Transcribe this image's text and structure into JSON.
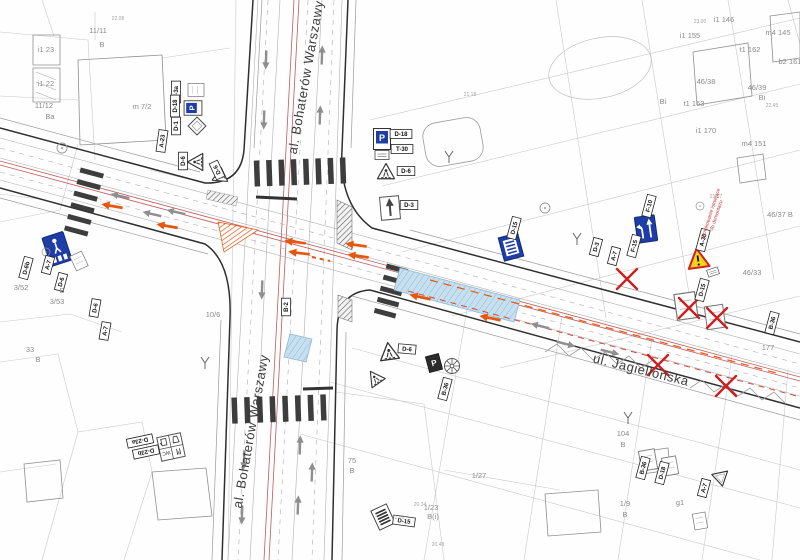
{
  "streets": [
    {
      "name": "al. Bohaterów Warszawy",
      "x": 310,
      "y": 78,
      "rot": -80
    },
    {
      "name": "al. Bohaterów Warszawy",
      "x": 255,
      "y": 432,
      "rot": -80
    },
    {
      "name": "ul. Jagiellońska",
      "x": 640,
      "y": 374,
      "rot": 14
    }
  ],
  "parcel_labels": [
    {
      "text": "11/11",
      "x": 98,
      "y": 33
    },
    {
      "text": "B",
      "x": 102,
      "y": 47
    },
    {
      "text": "i1 23",
      "x": 46,
      "y": 52
    },
    {
      "text": "i1 22",
      "x": 46,
      "y": 86
    },
    {
      "text": "11/12",
      "x": 44,
      "y": 108
    },
    {
      "text": "Ba",
      "x": 50,
      "y": 119
    },
    {
      "text": "m 7/2",
      "x": 142,
      "y": 109
    },
    {
      "text": "i1 146",
      "x": 724,
      "y": 22
    },
    {
      "text": "i1 155",
      "x": 690,
      "y": 38
    },
    {
      "text": "m4 145",
      "x": 778,
      "y": 35
    },
    {
      "text": "t1 162",
      "x": 750,
      "y": 52
    },
    {
      "text": "b2 161",
      "x": 790,
      "y": 64
    },
    {
      "text": "46/38",
      "x": 706,
      "y": 84
    },
    {
      "text": "46/39",
      "x": 757,
      "y": 90
    },
    {
      "text": "Bi",
      "x": 762,
      "y": 100
    },
    {
      "text": "Bi",
      "x": 663,
      "y": 104
    },
    {
      "text": "t1 163",
      "x": 694,
      "y": 106
    },
    {
      "text": "i1 170",
      "x": 706,
      "y": 133
    },
    {
      "text": "m4 151",
      "x": 754,
      "y": 146
    },
    {
      "text": "46/37 B",
      "x": 780,
      "y": 217
    },
    {
      "text": "46/33",
      "x": 752,
      "y": 275
    },
    {
      "text": "177",
      "x": 768,
      "y": 350
    },
    {
      "text": "104",
      "x": 623,
      "y": 436
    },
    {
      "text": "B",
      "x": 623,
      "y": 447
    },
    {
      "text": "1/9",
      "x": 625,
      "y": 506
    },
    {
      "text": "B",
      "x": 625,
      "y": 517
    },
    {
      "text": "1/23",
      "x": 431,
      "y": 510
    },
    {
      "text": "B(i)",
      "x": 433,
      "y": 519
    },
    {
      "text": "75",
      "x": 352,
      "y": 463
    },
    {
      "text": "B",
      "x": 352,
      "y": 473
    },
    {
      "text": "1/27",
      "x": 479,
      "y": 478
    },
    {
      "text": "g1",
      "x": 680,
      "y": 505
    },
    {
      "text": "10/6",
      "x": 213,
      "y": 317
    },
    {
      "text": "3/52",
      "x": 21,
      "y": 290
    },
    {
      "text": "B",
      "x": 62,
      "y": 293
    },
    {
      "text": "3/53",
      "x": 57,
      "y": 304
    },
    {
      "text": "33",
      "x": 30,
      "y": 352
    },
    {
      "text": "B",
      "x": 38,
      "y": 362
    }
  ],
  "elevation_labels": [
    {
      "text": "23.00",
      "x": 700,
      "y": 23
    },
    {
      "text": "22.45",
      "x": 772,
      "y": 107
    },
    {
      "text": "21.57",
      "x": 716,
      "y": 198
    },
    {
      "text": "21.18",
      "x": 470,
      "y": 96
    },
    {
      "text": "21.01",
      "x": 398,
      "y": 519
    },
    {
      "text": "20.34",
      "x": 420,
      "y": 506
    },
    {
      "text": "20.48",
      "x": 438,
      "y": 546
    },
    {
      "text": "22.08",
      "x": 118,
      "y": 20
    }
  ],
  "sign_labels": [
    {
      "text": "D-18",
      "x": 401,
      "y": 134,
      "rot": 0
    },
    {
      "text": "T-30",
      "x": 402,
      "y": 149,
      "rot": 0
    },
    {
      "text": "D-6",
      "x": 406,
      "y": 171,
      "rot": 0
    },
    {
      "text": "D-3",
      "x": 409,
      "y": 205,
      "rot": 0
    },
    {
      "text": "T-3a",
      "x": 176,
      "y": 92,
      "rot": -90
    },
    {
      "text": "D-18",
      "x": 175,
      "y": 106,
      "rot": -90
    },
    {
      "text": "D-1",
      "x": 176,
      "y": 126,
      "rot": -90
    },
    {
      "text": "A-23",
      "x": 162,
      "y": 141,
      "rot": -82
    },
    {
      "text": "D-6",
      "x": 183,
      "y": 161,
      "rot": -90
    },
    {
      "text": "D-6",
      "x": 217,
      "y": 170,
      "rot": -115
    },
    {
      "text": "D-6b",
      "x": 26,
      "y": 268,
      "rot": -75
    },
    {
      "text": "A-7",
      "x": 48,
      "y": 265,
      "rot": -75
    },
    {
      "text": "D-6",
      "x": 61,
      "y": 282,
      "rot": -75
    },
    {
      "text": "D-6",
      "x": 95,
      "y": 308,
      "rot": -80
    },
    {
      "text": "A-7",
      "x": 105,
      "y": 331,
      "rot": -80
    },
    {
      "text": "B-2",
      "x": 286,
      "y": 307,
      "rot": -90
    },
    {
      "text": "D-15",
      "x": 514,
      "y": 228,
      "rot": -75
    },
    {
      "text": "F-10",
      "x": 649,
      "y": 206,
      "rot": -75
    },
    {
      "text": "F-15",
      "x": 634,
      "y": 246,
      "rot": -75
    },
    {
      "text": "D-3",
      "x": 596,
      "y": 247,
      "rot": -75
    },
    {
      "text": "A-7",
      "x": 614,
      "y": 256,
      "rot": -75
    },
    {
      "text": "A-30",
      "x": 703,
      "y": 240,
      "rot": -75
    },
    {
      "text": "D-15",
      "x": 702,
      "y": 290,
      "rot": -75
    },
    {
      "text": "B-36",
      "x": 772,
      "y": 323,
      "rot": -75
    },
    {
      "text": "D-6",
      "x": 407,
      "y": 349,
      "rot": 5
    },
    {
      "text": "B-36",
      "x": 445,
      "y": 389,
      "rot": -75
    },
    {
      "text": "D-15",
      "x": 404,
      "y": 521,
      "rot": 8
    },
    {
      "text": "D-23a",
      "x": 140,
      "y": 441,
      "rot": 168
    },
    {
      "text": "D-23b",
      "x": 146,
      "y": 452,
      "rot": 168
    },
    {
      "text": "B-36",
      "x": 643,
      "y": 468,
      "rot": -75
    },
    {
      "text": "D-18",
      "x": 662,
      "y": 473,
      "rot": -75
    },
    {
      "text": "A-7",
      "x": 704,
      "y": 488,
      "rot": -75
    }
  ],
  "signs": [
    {
      "type": "parking",
      "x": 382,
      "y": 139,
      "rot": 0,
      "s": 1
    },
    {
      "type": "plate",
      "x": 382,
      "y": 155,
      "rot": 0,
      "s": 1
    },
    {
      "type": "tri-crossing",
      "x": 386,
      "y": 172,
      "rot": 0,
      "s": 0.9
    },
    {
      "type": "arrow-sign",
      "x": 390,
      "y": 208,
      "rot": -5,
      "s": 1
    },
    {
      "type": "box-sign",
      "x": 196,
      "y": 90,
      "rot": -90,
      "s": 0.8
    },
    {
      "type": "parking",
      "x": 193,
      "y": 108,
      "rot": -90,
      "s": 0.85
    },
    {
      "type": "diamond",
      "x": 197,
      "y": 126,
      "rot": 0,
      "s": 0.9
    },
    {
      "type": "tri-crossing",
      "x": 196,
      "y": 162,
      "rot": -90,
      "s": 0.9
    },
    {
      "type": "tri-crossing",
      "x": 219,
      "y": 177,
      "rot": -115,
      "s": 0.8
    },
    {
      "type": "blue-crossing",
      "x": 57,
      "y": 249,
      "rot": -18,
      "s": 1
    },
    {
      "type": "box-sign",
      "x": 79,
      "y": 261,
      "rot": -25,
      "s": 0.8
    },
    {
      "type": "bus-stop",
      "x": 511,
      "y": 247,
      "rot": -15,
      "s": 1
    },
    {
      "type": "lane-sign",
      "x": 646,
      "y": 229,
      "rot": -8,
      "s": 1
    },
    {
      "type": "warning",
      "x": 698,
      "y": 259,
      "rot": -8,
      "s": 1
    },
    {
      "type": "plate",
      "x": 713,
      "y": 272,
      "rot": -18,
      "s": 0.8
    },
    {
      "type": "parking-dark",
      "x": 434,
      "y": 363,
      "rot": -15,
      "s": 0.9
    },
    {
      "type": "wheel",
      "x": 452,
      "y": 366,
      "rot": 0,
      "s": 1
    },
    {
      "type": "tri-crossing",
      "x": 389,
      "y": 352,
      "rot": -8,
      "s": 1
    },
    {
      "type": "tri-crossing",
      "x": 375,
      "y": 378,
      "rot": -35,
      "s": 0.85
    },
    {
      "type": "stripes-sign",
      "x": 383,
      "y": 517,
      "rot": -25,
      "s": 1
    },
    {
      "type": "services",
      "x": 171,
      "y": 447,
      "rot": 168,
      "s": 1
    },
    {
      "type": "box-sign",
      "x": 686,
      "y": 306,
      "rot": -8,
      "s": 1.3
    },
    {
      "type": "box-sign",
      "x": 715,
      "y": 317,
      "rot": -8,
      "s": 1.15
    },
    {
      "type": "box-sign",
      "x": 648,
      "y": 460,
      "rot": -10,
      "s": 1
    },
    {
      "type": "box-sign",
      "x": 670,
      "y": 466,
      "rot": -10,
      "s": 0.9
    },
    {
      "type": "yield",
      "x": 721,
      "y": 479,
      "rot": -12,
      "s": 0.85
    },
    {
      "type": "box-sign",
      "x": 700,
      "y": 521,
      "rot": -10,
      "s": 0.8
    },
    {
      "type": "red-x",
      "x": 627,
      "y": 279,
      "rot": 0,
      "s": 1
    },
    {
      "type": "red-x",
      "x": 689,
      "y": 308,
      "rot": 0,
      "s": 1
    },
    {
      "type": "red-x",
      "x": 717,
      "y": 318,
      "rot": 0,
      "s": 1
    },
    {
      "type": "red-x",
      "x": 658,
      "y": 365,
      "rot": 0,
      "s": 1
    },
    {
      "type": "red-x",
      "x": 726,
      "y": 386,
      "rot": 0,
      "s": 1
    },
    {
      "type": "pole",
      "x": 205,
      "y": 363,
      "rot": 0,
      "s": 1
    },
    {
      "type": "pole",
      "x": 577,
      "y": 239,
      "rot": 0,
      "s": 1
    },
    {
      "type": "pole",
      "x": 449,
      "y": 157,
      "rot": 0,
      "s": 1
    },
    {
      "type": "pole",
      "x": 628,
      "y": 418,
      "rot": 0,
      "s": 1
    },
    {
      "type": "tree",
      "x": 62,
      "y": 148,
      "rot": 0,
      "s": 1
    },
    {
      "type": "tree",
      "x": 46,
      "y": 252,
      "rot": 0,
      "s": 0.8
    },
    {
      "type": "tree",
      "x": 545,
      "y": 208,
      "rot": 0,
      "s": 1
    },
    {
      "type": "tree",
      "x": 700,
      "y": 206,
      "rot": 0,
      "s": 0.8
    }
  ],
  "annotations": [
    {
      "lines": [
        "Oznakowanie istniejące",
        "do demontażu"
      ],
      "x": 712,
      "y": 214,
      "rot": -72,
      "color": "#cc3333"
    }
  ],
  "colors": {
    "marking_orange": "#e8560e",
    "sign_blue": "#1f3da6",
    "alert_red": "#cc2020",
    "surface_blue": "#c7e0f0",
    "axis_red": "#c25858",
    "warning_yellow": "#f7d417"
  }
}
